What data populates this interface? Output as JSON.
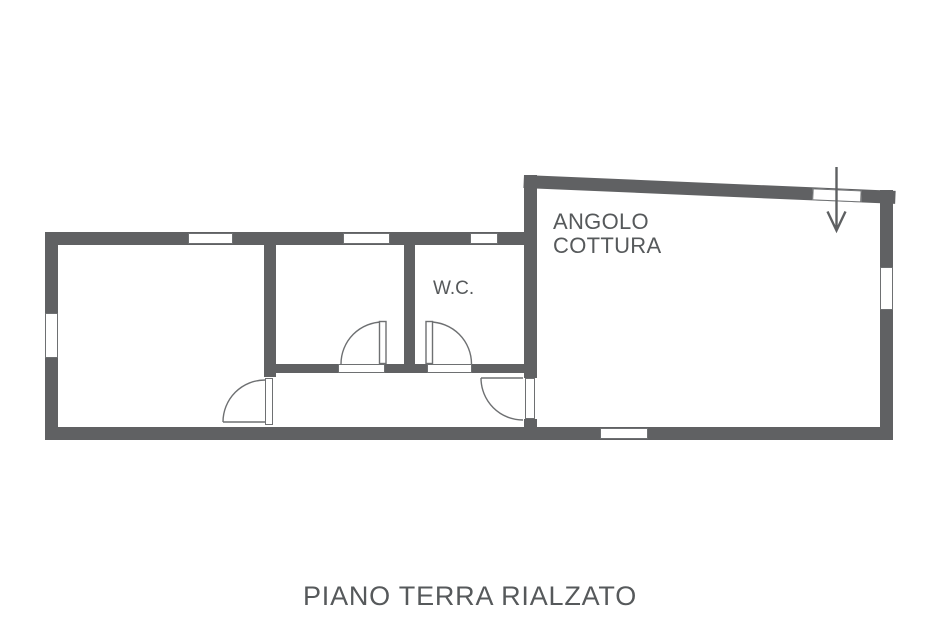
{
  "colors": {
    "wall": "#606163",
    "line": "#6e7072",
    "text": "#56595b"
  },
  "labels": {
    "kitchen_line1": "ANGOLO",
    "kitchen_line2": "COTTURA",
    "wc": "W.C.",
    "title": "PIANO TERRA RIALZATO"
  }
}
